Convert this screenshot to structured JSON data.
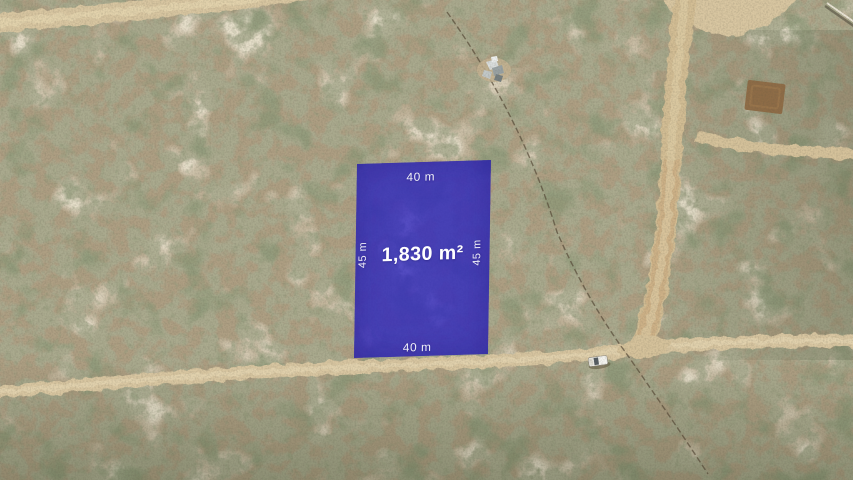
{
  "photo": {
    "alt": "Aerial drone photo of desert scrubland with dirt roads, a fence line, a white vehicle and a highlighted lot",
    "colors": {
      "lot_overlay": "rgba(44,36,192,0.78)",
      "road": "#d8c6a1",
      "terrain_base": "#ae9f83",
      "label_text": "#ffffff"
    }
  },
  "lot": {
    "area": "1,830 m²",
    "top_width": "40 m",
    "bottom_width": "40 m",
    "left_depth": "45 m",
    "right_depth": "45 m"
  }
}
